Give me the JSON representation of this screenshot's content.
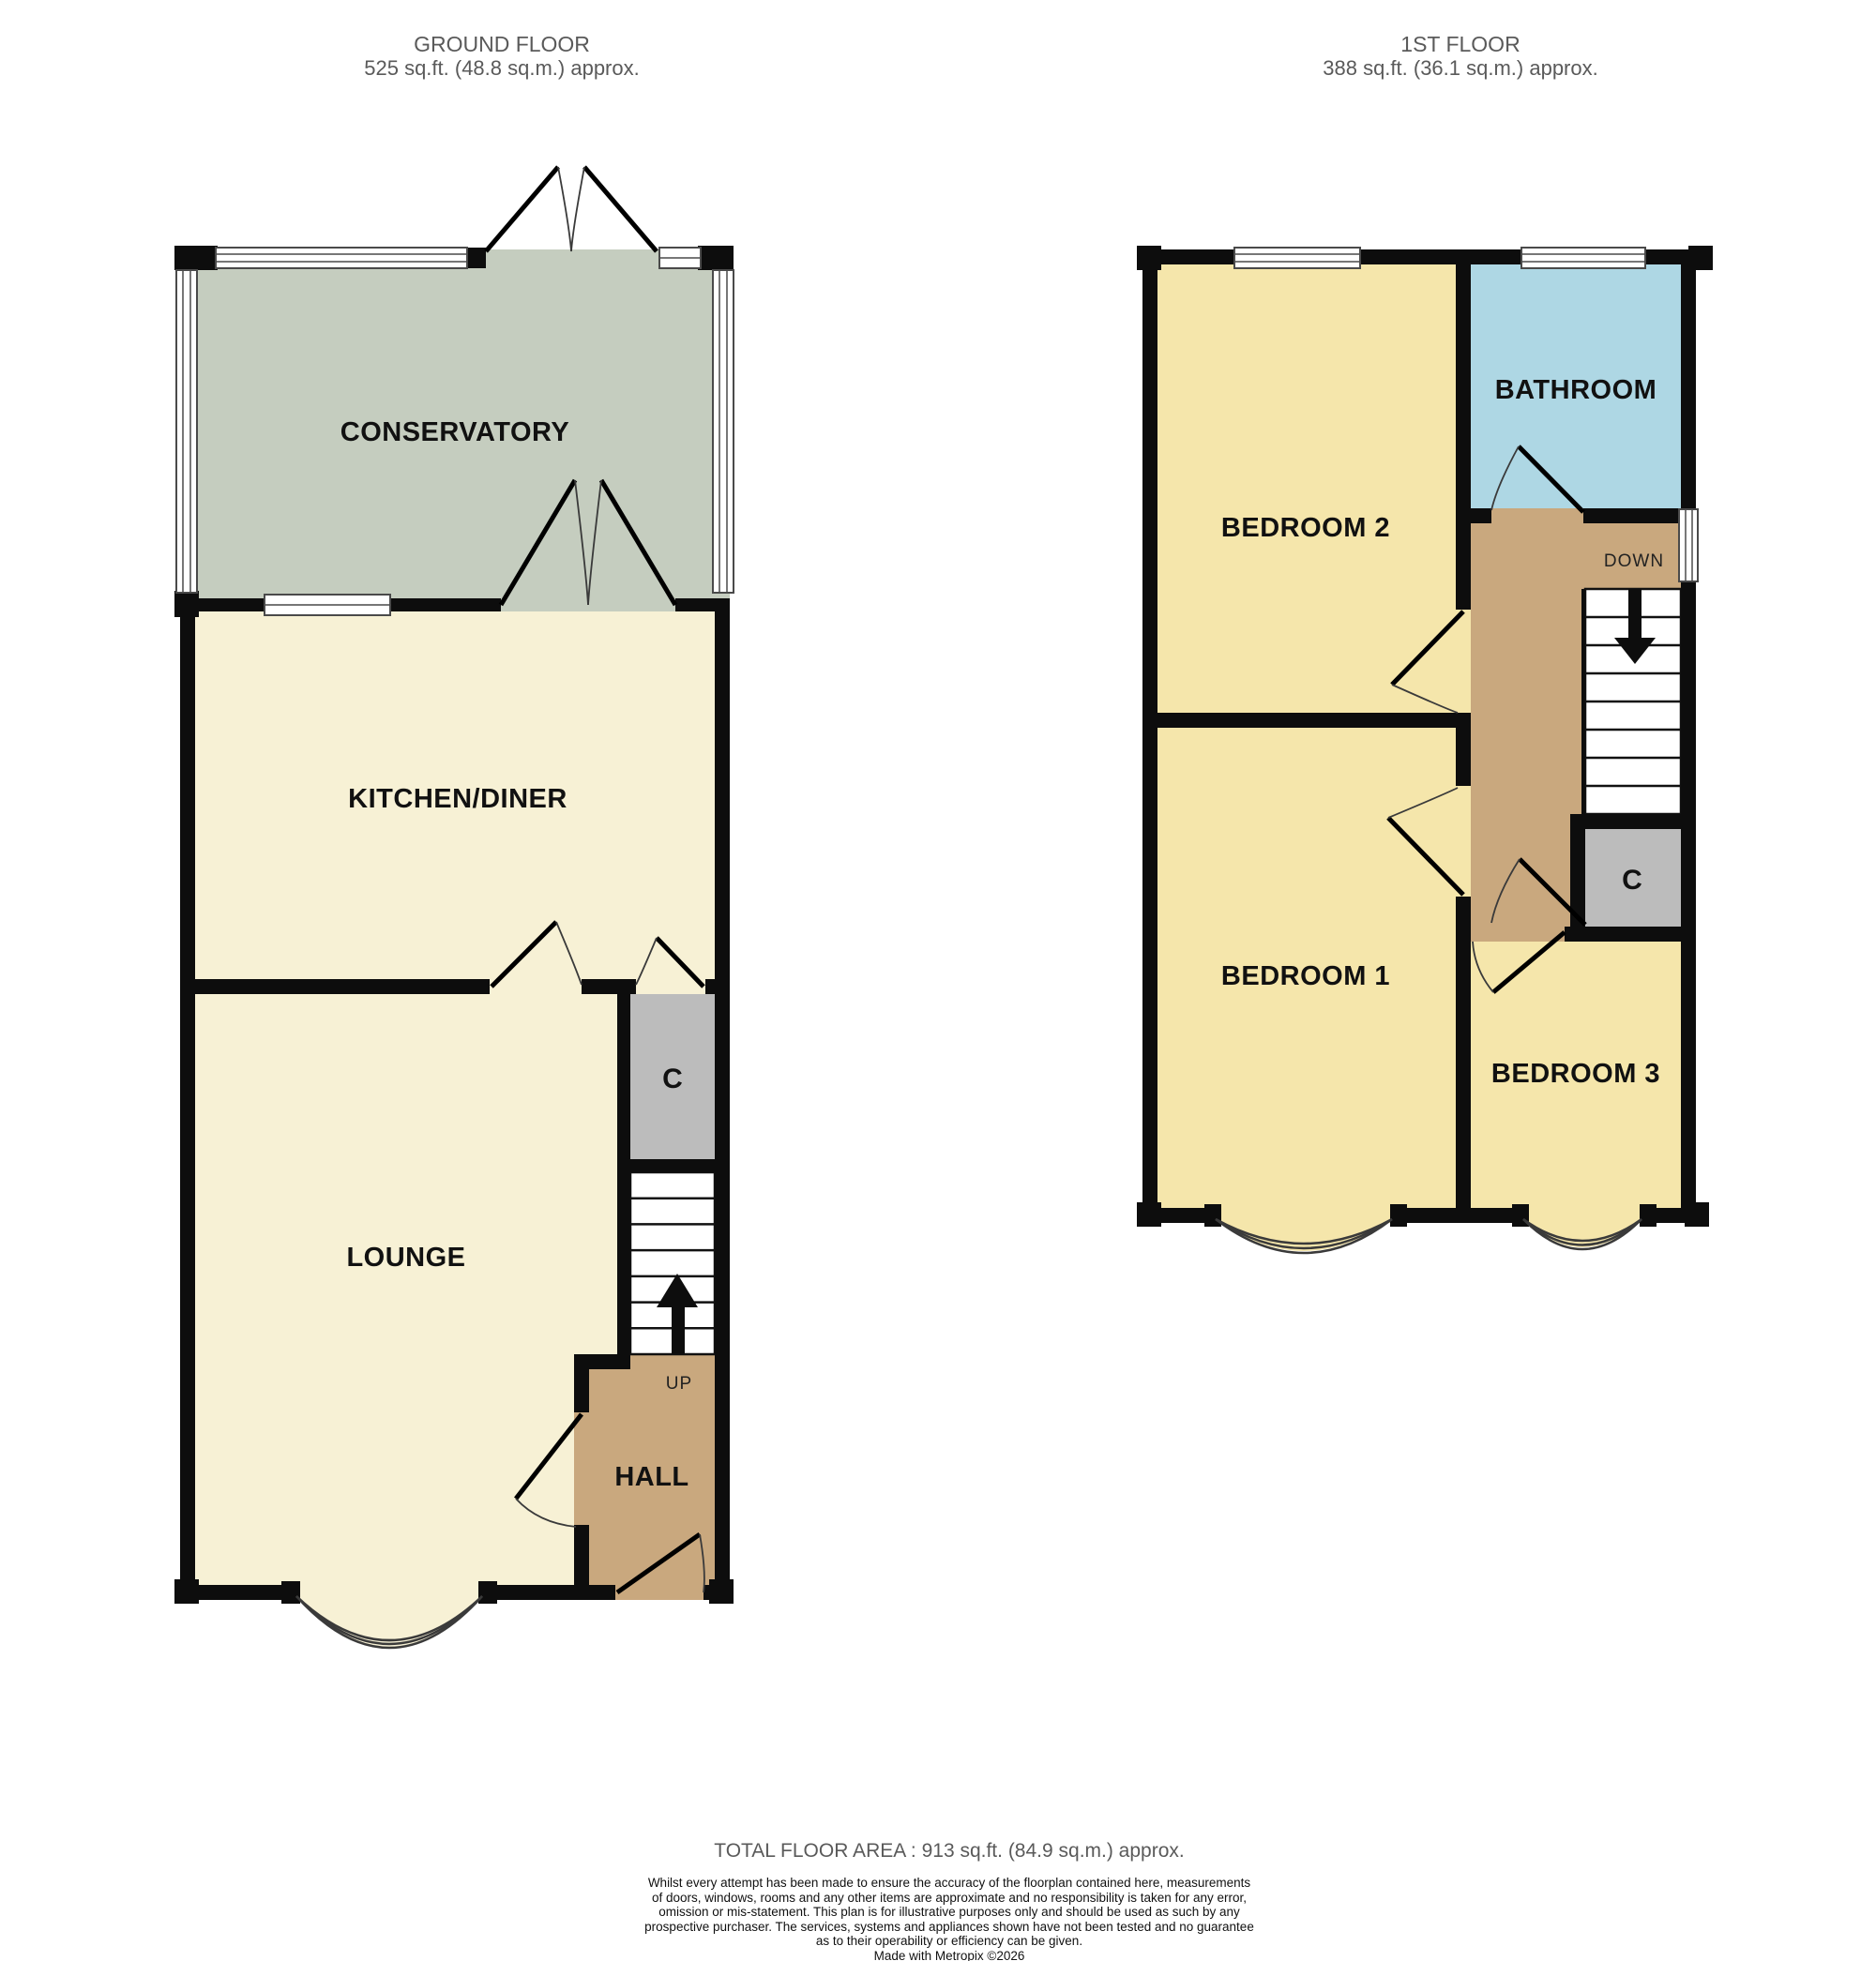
{
  "ground": {
    "title": "GROUND FLOOR",
    "area": "525 sq.ft. (48.8 sq.m.) approx.",
    "rooms": {
      "conservatory": "CONSERVATORY",
      "kitchen": "KITCHEN/DINER",
      "lounge": "LOUNGE",
      "hall": "HALL",
      "cupboard": "C"
    },
    "stairs_label": "UP"
  },
  "first": {
    "title": "1ST FLOOR",
    "area": "388 sq.ft. (36.1 sq.m.) approx.",
    "rooms": {
      "bedroom2": "BEDROOM 2",
      "bathroom": "BATHROOM",
      "bedroom1": "BEDROOM 1",
      "bedroom3": "BEDROOM 3",
      "cupboard": "C"
    },
    "stairs_label": "DOWN"
  },
  "footer": {
    "total": "TOTAL FLOOR AREA : 913 sq.ft. (84.9 sq.m.) approx.",
    "disclaimer_lines": [
      "Whilst every attempt has been made to ensure the accuracy of the floorplan contained here, measurements",
      "of doors, windows, rooms and any other items are approximate and no responsibility is taken for any error,",
      "omission or mis-statement. This plan is for illustrative purposes only and should be used as such by any",
      "prospective purchaser. The services, systems and appliances shown have not been tested and no guarantee",
      "as to their operability or efficiency can be given."
    ],
    "credit": "Made with Metropix ©2026"
  },
  "colors": {
    "cream": "#f7f1d5",
    "conservatory_green": "#c5cdbf",
    "bedroom_yellow": "#f5e6ab",
    "bathroom_blue": "#aed7e4",
    "hall_tan": "#c9a87e",
    "cupboard_gray": "#bcbcbc",
    "wall_black": "#0d0d0d",
    "header_gray": "#5a5a5a"
  }
}
